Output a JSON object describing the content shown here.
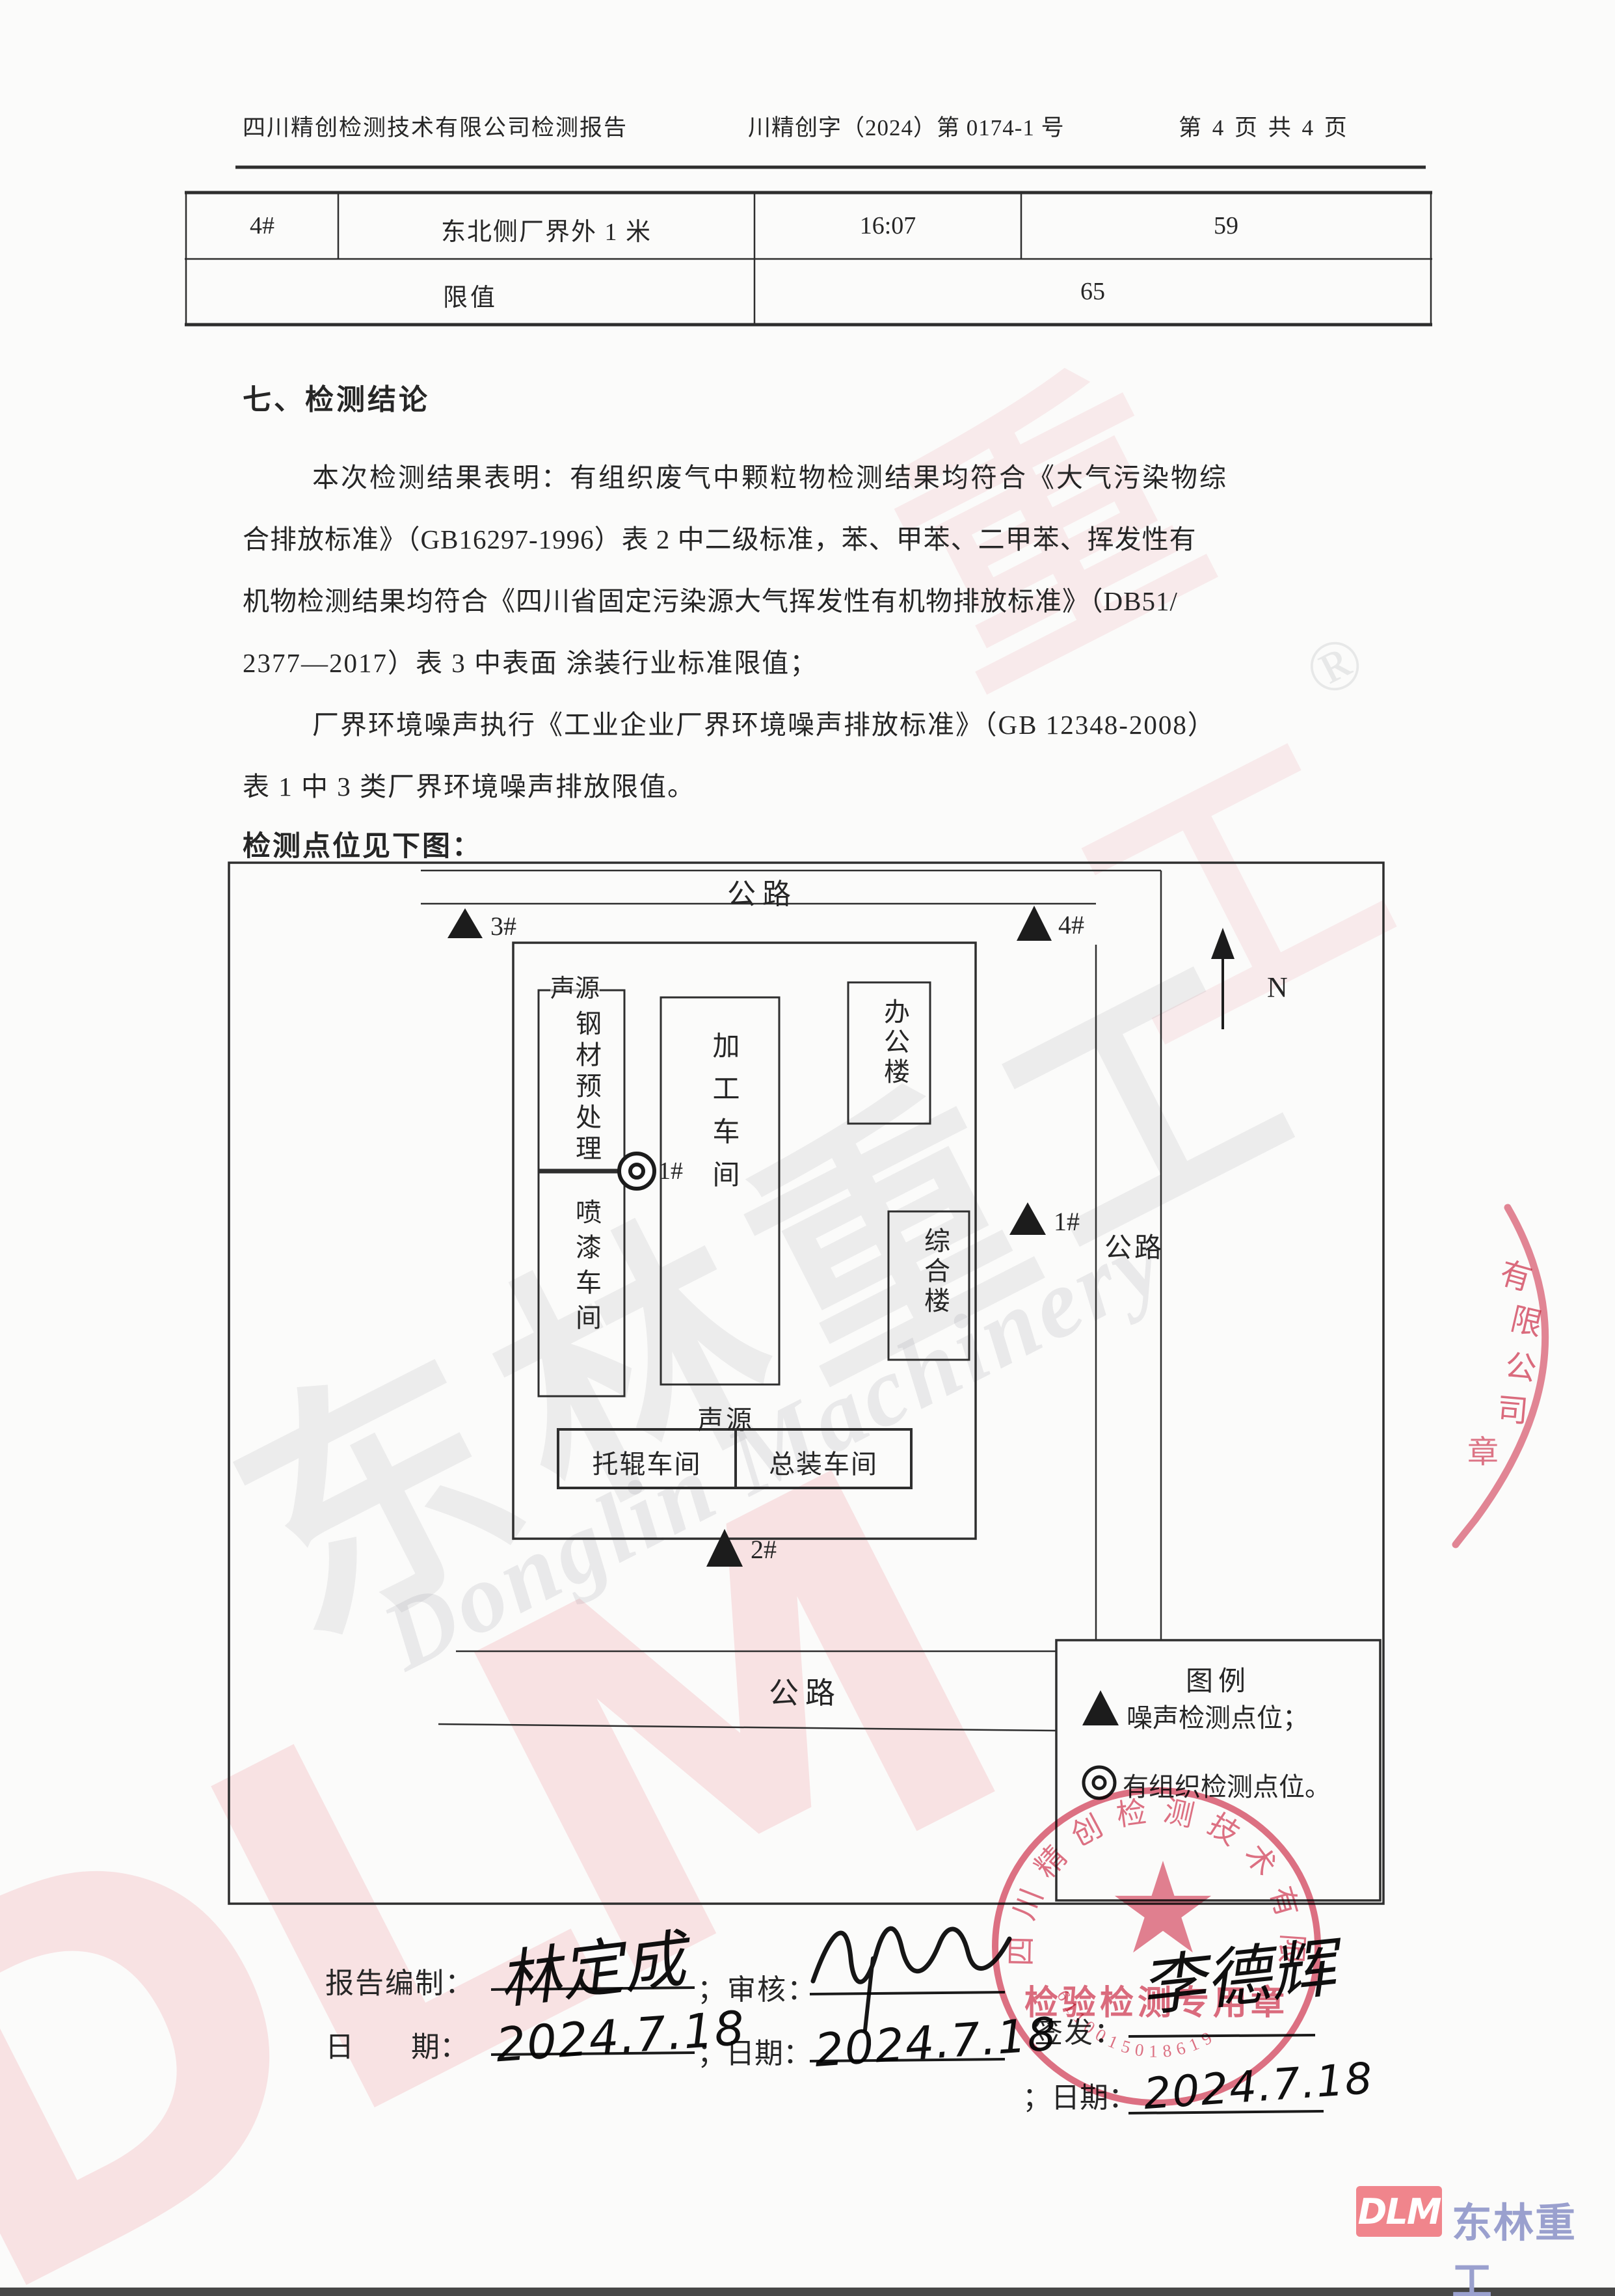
{
  "header": {
    "left": "四川精创检测技术有限公司检测报告",
    "center": "川精创字（2024）第 0174-1 号",
    "right": "第 4 页 共 4 页"
  },
  "table": {
    "point": "4#",
    "location": "东北侧厂界外 1 米",
    "time": "16:07",
    "value": "59",
    "limit_label": "限值",
    "limit_value": "65"
  },
  "conclusion": {
    "title": "七、检测结论",
    "line1": "本次检测结果表明：有组织废气中颗粒物检测结果均符合《大气污染物综",
    "line2": "合排放标准》（GB16297-1996）表 2 中二级标准，苯、甲苯、二甲苯、挥发性有",
    "line3": "机物检测结果均符合《四川省固定污染源大气挥发性有机物排放标准》（DB51/",
    "line4": "2377—2017）表 3 中表面 涂装行业标准限值；",
    "line5": "厂界环境噪声执行《工业企业厂界环境噪声排放标准》（GB 12348-2008）",
    "line6": "表 1 中 3 类厂界环境噪声排放限值。",
    "map_intro": "检测点位见下图："
  },
  "diagram": {
    "road_top": "公路",
    "road_right": "公路",
    "road_bottom": "公路",
    "north": "N",
    "source_left": "声源",
    "source_bottom": "声源",
    "buildings": {
      "steel": "钢材预处理",
      "paint": "喷漆车间",
      "process": "加工车间",
      "office": "办公楼",
      "complex": "综合楼",
      "roller": "托辊车间",
      "assembly": "总装车间"
    },
    "points": {
      "p1": "1#",
      "p2": "2#",
      "p3": "3#",
      "p4": "4#",
      "emission": "1#"
    }
  },
  "legend": {
    "title": "图例",
    "noise": "噪声检测点位；",
    "emission": "有组织检测点位。"
  },
  "signoff": {
    "prepared_label": "报告编制：",
    "prepared_sig": "林定成",
    "review_label": "；审核：",
    "issue_label": "签发：",
    "issue_sig": "李德辉",
    "date1_label": "日　　期：",
    "date2_label": "；日期：",
    "date3_label": "；日期：",
    "date1": "2024.7.18",
    "date2": "2024.7.18",
    "date3": "2024.7.18"
  },
  "stamp": {
    "arc_text": "四川精创检测技术有限",
    "band_text": "检验检测专用章",
    "serial": "6110015018619"
  },
  "stamp_right": {
    "chars": [
      "有",
      "限",
      "公",
      "司",
      "章"
    ]
  },
  "watermark": {
    "dlm": "DLM",
    "cn": "东林重工",
    "en": "Donglin Machinery",
    "reg": "®",
    "fragment": "重工"
  },
  "footer": {
    "logo_short": "DLM",
    "logo_name": "东林重工"
  }
}
